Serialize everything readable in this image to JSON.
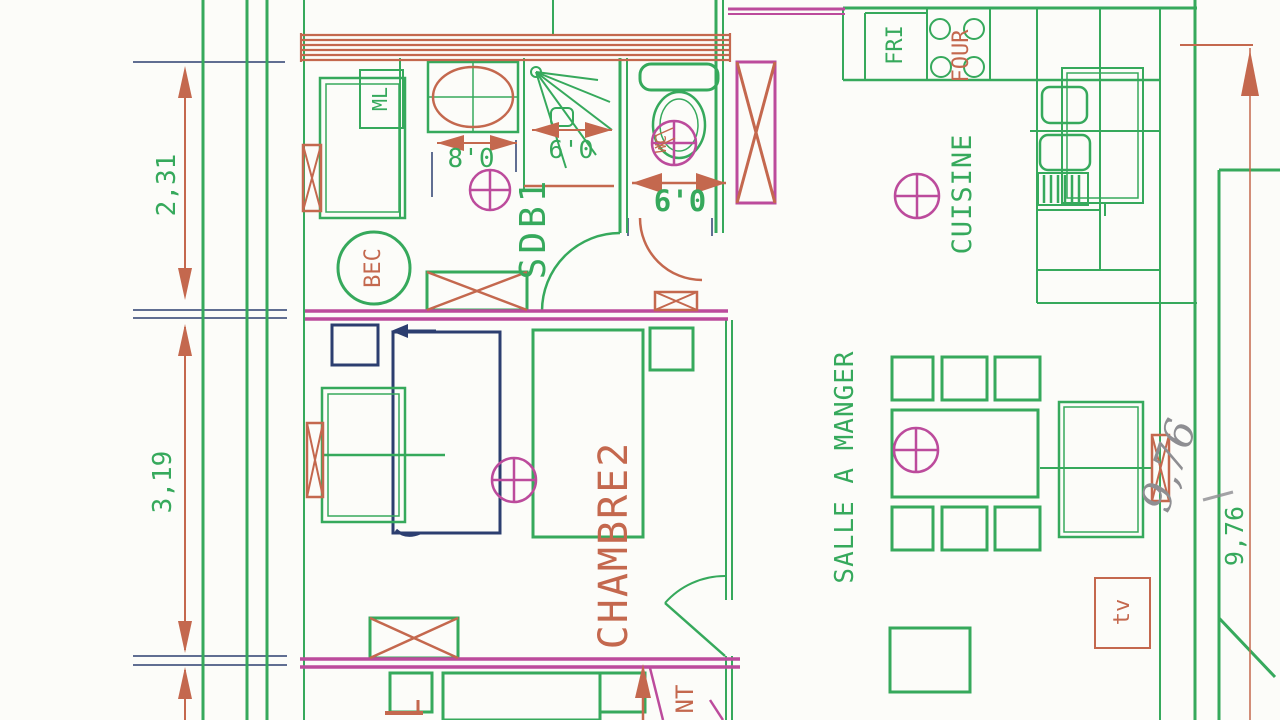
{
  "document": {
    "type": "scanned architectural floor plan"
  },
  "colors": {
    "wall_green": "#36a95c",
    "dimension_red": "#c4684e",
    "partition_magenta": "#bc4b9c",
    "pen_navy": "#2c3e70",
    "pencil_gray": "#8e8e92",
    "paper": "#fcfcf9"
  },
  "rooms": {
    "sdb1": "SDB1",
    "wc": "WC",
    "cuisine": "CUISINE",
    "salle_a_manger": "SALLE A MANGER",
    "chambre2": "CHAMBRE2"
  },
  "appliances": {
    "fridge": "FRI",
    "oven": "FOUR",
    "washer": "ML",
    "bec": "BEC",
    "tv": "tv"
  },
  "dimensions": {
    "left_top": "2,31",
    "left_bottom": "3,19",
    "bath_width": "8'0",
    "shower_width": "6'0",
    "wc_width": "6'0",
    "right_height": "9,76"
  },
  "annotations": {
    "pencil_note": "9,76",
    "partial_label": "NT"
  }
}
